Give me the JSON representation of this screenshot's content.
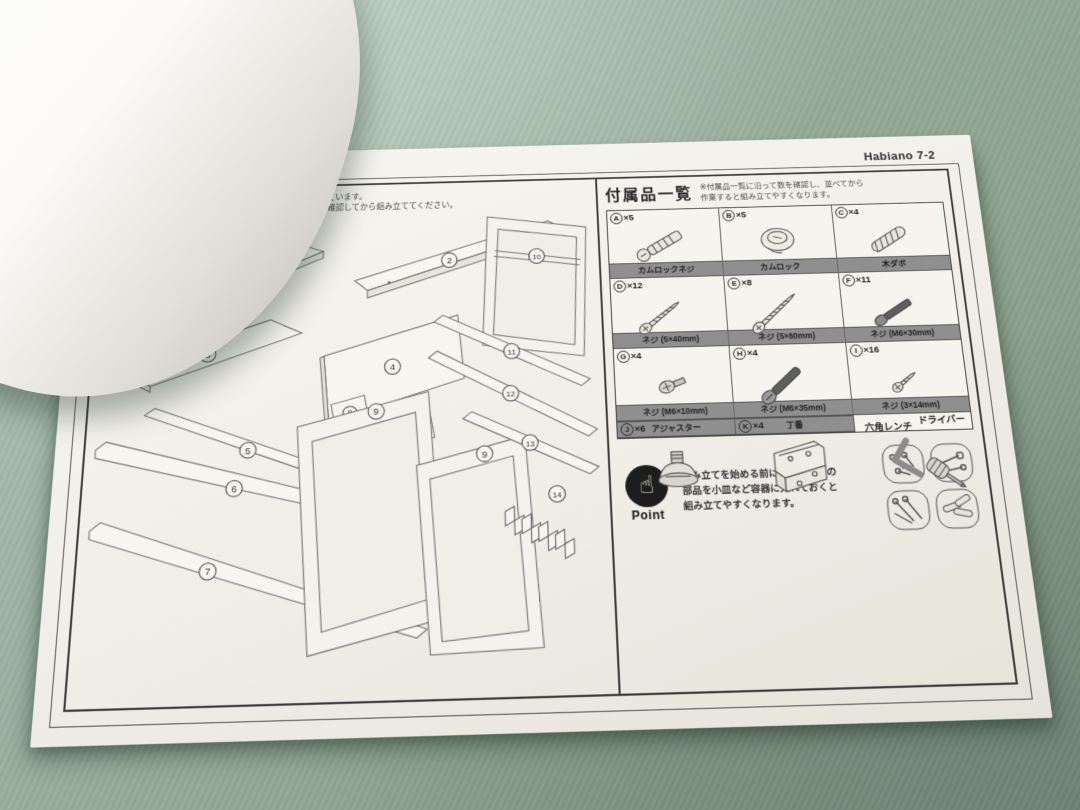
{
  "page_code": "Habiano 7-2",
  "colors": {
    "fabric_green": "#97ac9b",
    "sheet_white": "#f3f1ec",
    "band_gray": "#8f8f8f",
    "ink": "#3a3a3a"
  },
  "parts_panel": {
    "title": "部品一覧",
    "note_line1": "※各部品には、番号のシールが貼られています。",
    "note_line2": "その番号にしたがって、パーツの数を確認してから組み立ててください。",
    "numbers": [
      "1",
      "2",
      "3",
      "4",
      "5",
      "6",
      "7",
      "8",
      "8",
      "9",
      "9",
      "10",
      "11",
      "12",
      "13",
      "14"
    ]
  },
  "accessories_panel": {
    "title": "付属品一覧",
    "note_line1": "※付属品一覧に沿って数を確認し、並べてから",
    "note_line2": "作業すると組み立てやすくなります。",
    "items": [
      {
        "letter": "A",
        "count": "×5",
        "name": "カムロックネジ"
      },
      {
        "letter": "B",
        "count": "×5",
        "name": "カムロック"
      },
      {
        "letter": "C",
        "count": "×4",
        "name": "木ダボ"
      },
      {
        "letter": "D",
        "count": "×12",
        "name": "ネジ (5×40mm)"
      },
      {
        "letter": "E",
        "count": "×8",
        "name": "ネジ (5×60mm)"
      },
      {
        "letter": "F",
        "count": "×11",
        "name": "ネジ (M6×30mm)"
      },
      {
        "letter": "G",
        "count": "×4",
        "name": "ネジ (M6×10mm)"
      },
      {
        "letter": "H",
        "count": "×4",
        "name": "ネジ (M6×35mm)"
      },
      {
        "letter": "I",
        "count": "×16",
        "name": "ネジ (3×14mm)"
      },
      {
        "letter": "J",
        "count": "×6",
        "name": "アジャスター"
      },
      {
        "letter": "K",
        "count": "×4",
        "name": "丁番"
      }
    ],
    "tools": {
      "hex_wrench": "六角レンチ",
      "screwdriver": "ドライバー"
    }
  },
  "point": {
    "label": "Point",
    "hand_icon": "☝",
    "line1": "組み立てを始める前に、ネジなどの",
    "line2": "部品を小皿など容器に入れておくと",
    "line3": "組み立てやすくなります。"
  }
}
